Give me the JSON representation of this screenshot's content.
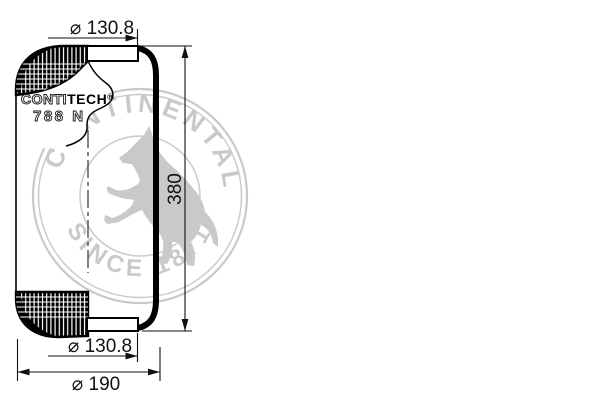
{
  "drawing": {
    "title": "air-spring-bellows-technical-drawing",
    "dimensions": {
      "top_diameter": "⌀ 130.8",
      "height": "380",
      "bottom_diameter": "⌀ 130.8",
      "base_diameter": "⌀ 190"
    },
    "label": {
      "brand_outline": "CONTI",
      "brand_solid": "TECH",
      "reg": "®",
      "model": "788 N"
    },
    "watermark": {
      "arc_text": "CONTINENTAL",
      "bottom_text": "SINCE 1871"
    },
    "colors": {
      "ink": "#000000",
      "watermark": "#c9c9c9",
      "background": "#ffffff"
    }
  }
}
